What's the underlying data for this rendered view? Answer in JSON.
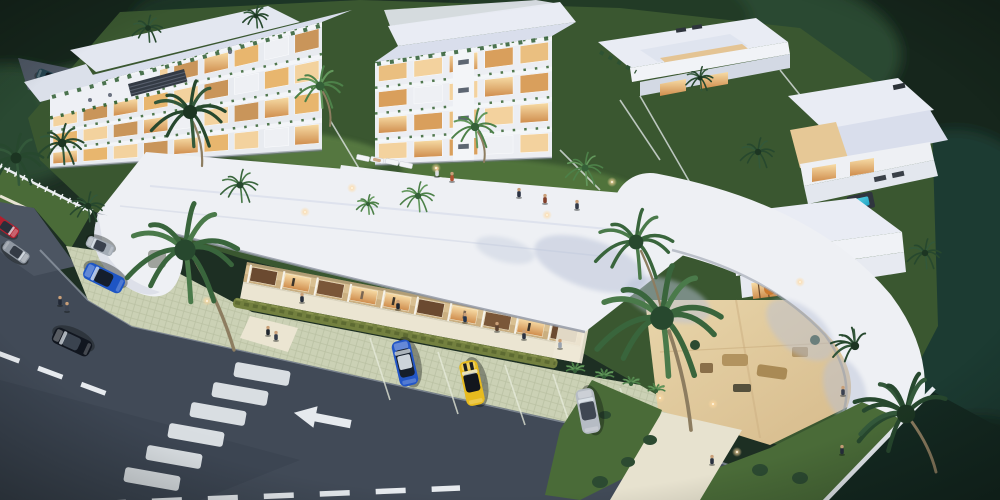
{
  "scene": {
    "description": "Aerial dusk 3D architectural rendering of a tropical residential resort complex with white apartment blocks, villas, a pool, a retail strip, palm trees, parking lot and road"
  },
  "colors": {
    "canvas_bg": "#1d2f23",
    "foliage_dark": "#16271b",
    "foliage_mid": "#2c4832",
    "foliage_light": "#3e5f41",
    "foliage_teal": "#1d3a33",
    "grass": "#4a6b38",
    "grass_light": "#5d8044",
    "lawn_dark": "#3a5730",
    "building_white": "#eef0f4",
    "building_face": "#e8ebf0",
    "roof_light": "#e9ecf4",
    "roof_lavender": "#d9deec",
    "window_warm_hi": "#f7dca6",
    "window_warm_lo": "#cf8d4d",
    "storefront_tan": "#d9c092",
    "storefront_tan_dark": "#c2a374",
    "sidewalk": "#ebe5d2",
    "path": "#e7e2cf",
    "sand": "#e8d5aa",
    "sand_dark": "#d6ba8b",
    "hedge": "#73803f",
    "hedge_dark": "#5d6a32",
    "pavers": "#cbd1b5",
    "pavers_line": "#b7bea0",
    "road": "#414a57",
    "road_lane": "#4c5562",
    "curb": "#97a0ab",
    "marking": "#e6eaee",
    "pool_hi": "#62d6e4",
    "pool_lo": "#1ea2c3",
    "deck": "#edf0f3",
    "trunk": "#8d7d60",
    "lamp": "#ffd9a0",
    "skin": "#c99f78"
  },
  "buildings": [
    {
      "name": "apartment-block-west",
      "quad": [
        [
          50,
          168
        ],
        [
          322,
          150
        ],
        [
          322,
          22
        ],
        [
          50,
          95
        ]
      ],
      "floors": 4,
      "bays": 9,
      "face": "#e8ebf0",
      "win": [
        "url(#winG)",
        "#e8b66e",
        "#f3d29e",
        "#c9955a"
      ],
      "blanks": [
        [
          3,
          2
        ],
        [
          2,
          6
        ],
        [
          1,
          4
        ],
        [
          0,
          7
        ],
        [
          3,
          7
        ]
      ],
      "plants": true
    },
    {
      "name": "apartment-block-center",
      "quad": [
        [
          375,
          165
        ],
        [
          552,
          158
        ],
        [
          552,
          36
        ],
        [
          375,
          62
        ]
      ],
      "floors": 4,
      "bays": 5,
      "face": "#eceef3",
      "win": [
        "#f3d29e",
        "url(#winG)",
        "#d99f5c",
        "#eabf80"
      ],
      "blanks": [
        [
          2,
          1
        ],
        [
          0,
          3
        ]
      ],
      "core": true,
      "plants": true
    }
  ],
  "cars": [
    {
      "name": "parked-car-red",
      "x": 6,
      "y": 227,
      "rot": 35,
      "s": 0.6,
      "body": "#b01f2e",
      "glass": "#2a2f3a"
    },
    {
      "name": "parked-car-gray",
      "x": 16,
      "y": 252,
      "rot": 35,
      "s": 0.62,
      "body": "#8f97a1",
      "glass": "#343b45"
    },
    {
      "name": "parked-car-silver",
      "x": 100,
      "y": 246,
      "rot": 204,
      "s": 0.62,
      "body": "#a3abb5",
      "glass": "#3a414d"
    },
    {
      "name": "parked-car-blue",
      "x": 104,
      "y": 278,
      "rot": 206,
      "s": 0.92,
      "body": "#1e55c4",
      "glass": "#141e2c"
    },
    {
      "name": "driving-car-black",
      "x": 72,
      "y": 342,
      "rot": 205,
      "s": 0.88,
      "body": "#11161f",
      "glass": "#3a434f"
    },
    {
      "name": "driveway-car-teal",
      "x": 50,
      "y": 78,
      "rot": 22,
      "s": 0.6,
      "body": "#23424e",
      "glass": "#0e161d",
      "layer": "back"
    },
    {
      "name": "parking-car-blue-suv",
      "x": 405,
      "y": 363,
      "rot": -103,
      "s": 1,
      "body": "#2356c6",
      "glass": "#161f2c",
      "roof": "#ccd3da",
      "suv": true
    },
    {
      "name": "parking-car-yellow",
      "x": 472,
      "y": 383,
      "rot": -102,
      "s": 0.98,
      "body": "#e7bb1e",
      "glass": "#12161d",
      "stripes": "#1a1d22"
    },
    {
      "name": "parking-car-gray",
      "x": 588,
      "y": 411,
      "rot": -101,
      "s": 0.98,
      "body": "#b6bcc4",
      "glass": "#3f4752"
    }
  ],
  "palms": [
    {
      "x": 185,
      "y": 250,
      "r": 66,
      "t": "m",
      "tr": [
        196,
        262,
        234,
        350
      ]
    },
    {
      "x": 190,
      "y": 112,
      "r": 44,
      "t": "d",
      "tr": [
        193,
        122,
        202,
        166
      ]
    },
    {
      "x": 16,
      "y": 158,
      "r": 34,
      "t": "d"
    },
    {
      "x": 62,
      "y": 143,
      "r": 27,
      "t": "d"
    },
    {
      "x": 148,
      "y": 28,
      "r": 18,
      "t": "d"
    },
    {
      "x": 256,
      "y": 16,
      "r": 15,
      "t": "d"
    },
    {
      "x": 88,
      "y": 206,
      "r": 20,
      "t": "d"
    },
    {
      "x": 240,
      "y": 185,
      "r": 22,
      "t": "m"
    },
    {
      "x": 320,
      "y": 86,
      "r": 28,
      "t": "l",
      "tr": [
        323,
        92,
        330,
        126
      ]
    },
    {
      "x": 475,
      "y": 127,
      "r": 26,
      "t": "l",
      "tr": [
        478,
        132,
        484,
        162
      ]
    },
    {
      "x": 585,
      "y": 168,
      "r": 22,
      "t": "l"
    },
    {
      "x": 418,
      "y": 196,
      "r": 20,
      "t": "l"
    },
    {
      "x": 368,
      "y": 204,
      "r": 13,
      "t": "l"
    },
    {
      "x": 636,
      "y": 242,
      "r": 46,
      "t": "m",
      "tr": [
        641,
        251,
        665,
        328
      ]
    },
    {
      "x": 662,
      "y": 318,
      "r": 74,
      "t": "m",
      "tr": [
        669,
        331,
        691,
        430
      ]
    },
    {
      "x": 758,
      "y": 152,
      "r": 20,
      "t": "d"
    },
    {
      "x": 700,
      "y": 78,
      "r": 16,
      "t": "d"
    },
    {
      "x": 925,
      "y": 253,
      "r": 20,
      "t": "d"
    },
    {
      "x": 906,
      "y": 414,
      "r": 58,
      "t": "d",
      "a0": 110,
      "a1": 330,
      "tr": [
        912,
        422,
        936,
        472
      ]
    },
    {
      "x": 855,
      "y": 346,
      "r": 26,
      "t": "d",
      "a0": 120,
      "a1": 300
    },
    {
      "x": 575,
      "y": 371,
      "r": 12,
      "t": "l",
      "a0": -170,
      "a1": -10
    },
    {
      "x": 604,
      "y": 377,
      "r": 12,
      "t": "l",
      "a0": -170,
      "a1": -10
    },
    {
      "x": 631,
      "y": 384,
      "r": 11,
      "t": "l",
      "a0": -170,
      "a1": -10
    },
    {
      "x": 656,
      "y": 391,
      "r": 11,
      "t": "l",
      "a0": -170,
      "a1": -10
    }
  ],
  "people": [
    {
      "x": 302,
      "y": 300,
      "c": "#262e3c"
    },
    {
      "x": 398,
      "y": 307,
      "c": "#1e252f"
    },
    {
      "x": 465,
      "y": 320,
      "c": "#23344c"
    },
    {
      "x": 497,
      "y": 329,
      "c": "#5d4332"
    },
    {
      "x": 524,
      "y": 337,
      "c": "#2b3140"
    },
    {
      "x": 560,
      "y": 346,
      "c": "#99a2ae"
    },
    {
      "x": 60,
      "y": 303,
      "c": "#222936"
    },
    {
      "x": 67,
      "y": 309,
      "c": "#3c4452"
    },
    {
      "x": 268,
      "y": 333,
      "c": "#20262e"
    },
    {
      "x": 276,
      "y": 338,
      "c": "#363e4c"
    },
    {
      "x": 437,
      "y": 174,
      "c": "#d8dce2"
    },
    {
      "x": 452,
      "y": 179,
      "c": "#b05232"
    },
    {
      "x": 519,
      "y": 195,
      "c": "#2b3242"
    },
    {
      "x": 545,
      "y": 201,
      "c": "#813f2a"
    },
    {
      "x": 577,
      "y": 207,
      "c": "#333a48"
    },
    {
      "x": 843,
      "y": 393,
      "c": "#3a4150"
    },
    {
      "x": 842,
      "y": 452,
      "c": "#262d3a"
    },
    {
      "x": 712,
      "y": 462,
      "c": "#2b3240"
    }
  ],
  "loungers": [
    {
      "x": 449,
      "y": 190,
      "rot": 12
    },
    {
      "x": 466,
      "y": 193,
      "rot": 12,
      "p": "#caa07a"
    },
    {
      "x": 483,
      "y": 196,
      "rot": 12,
      "p": "#c4503a"
    },
    {
      "x": 501,
      "y": 199,
      "rot": 12
    },
    {
      "x": 518,
      "y": 202,
      "rot": 12,
      "p": "#caa07a"
    },
    {
      "x": 535,
      "y": 205,
      "rot": 12
    },
    {
      "x": 363,
      "y": 158,
      "rot": 12
    },
    {
      "x": 377,
      "y": 160,
      "rot": 12,
      "p": "#caa07a"
    },
    {
      "x": 392,
      "y": 162,
      "rot": 12
    },
    {
      "x": 406,
      "y": 165,
      "rot": 12
    }
  ],
  "crosswalk": {
    "rot": 10,
    "w": 56,
    "h": 15,
    "stripes": [
      [
        152,
        479
      ],
      [
        174,
        457
      ],
      [
        196,
        435
      ],
      [
        218,
        414
      ],
      [
        240,
        394
      ],
      [
        262,
        374
      ]
    ]
  },
  "lamps": [
    {
      "x": 207,
      "y": 301
    },
    {
      "x": 352,
      "y": 188
    },
    {
      "x": 547,
      "y": 215
    },
    {
      "x": 436,
      "y": 168
    },
    {
      "x": 660,
      "y": 398
    },
    {
      "x": 713,
      "y": 404
    },
    {
      "x": 737,
      "y": 452
    },
    {
      "x": 305,
      "y": 212
    },
    {
      "x": 612,
      "y": 182
    },
    {
      "x": 800,
      "y": 282
    }
  ]
}
